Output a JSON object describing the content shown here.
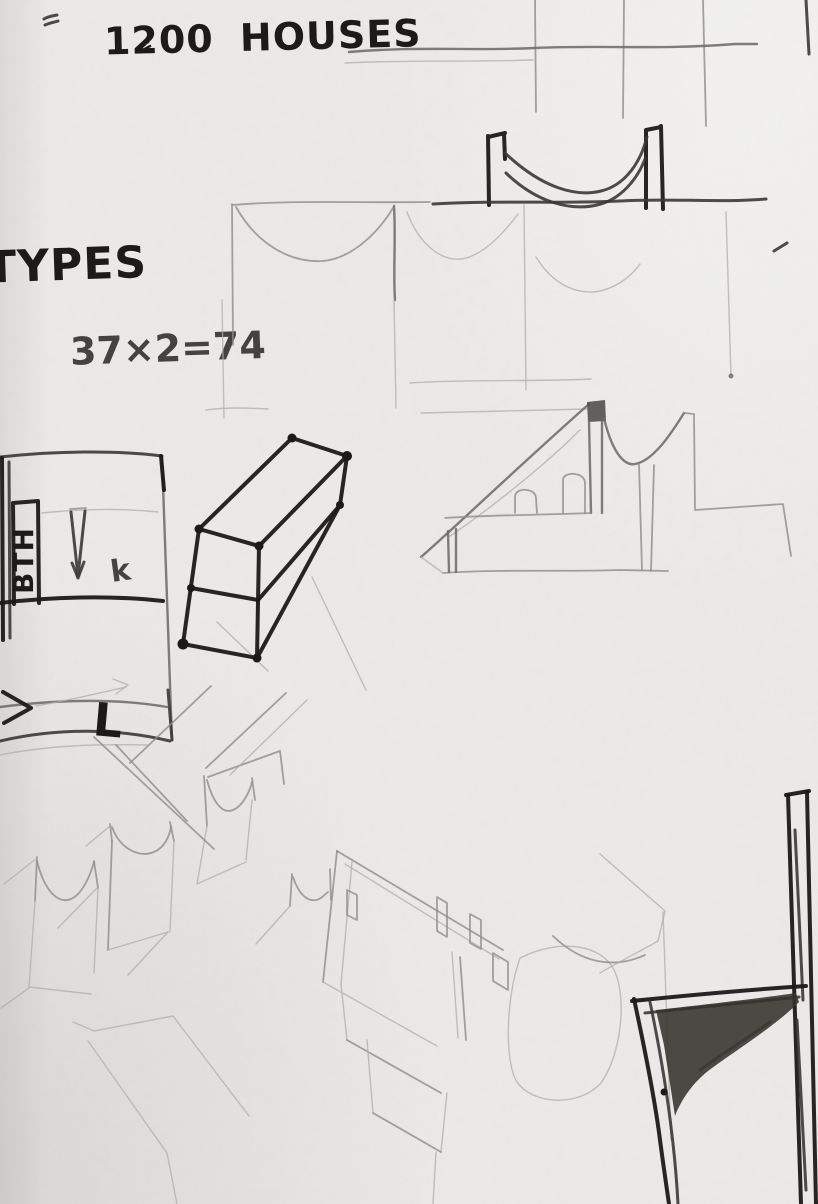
{
  "meta": {
    "description": "pencil sketchbook page - vaulted mass-housing studies",
    "paper_color": "#edecea",
    "graphite_dark": "#1c1a18",
    "graphite_medium": "#6b6864",
    "graphite_light": "#b0ada8"
  },
  "annotations": {
    "houses_note": "1200 HOUSES",
    "equals_mark": "=",
    "types_label": "TYPES",
    "calc_note": "37×2=74",
    "bath_label": "BTH",
    "length_label": "L",
    "plan_mark": "k"
  },
  "sketches": {
    "grid_study": "column-grid study",
    "vault_section": "suspended vault roof section",
    "vault_elevation": "vault bay elevation",
    "perspective_house": "vaulted house perspective",
    "unit_block": "unit block axonometric",
    "unit_plan": "unit plan with bath strip",
    "vault_modules": "vault module row",
    "interior_axon": "interior walls axonometric",
    "frame_detail": "structural frame detail"
  }
}
